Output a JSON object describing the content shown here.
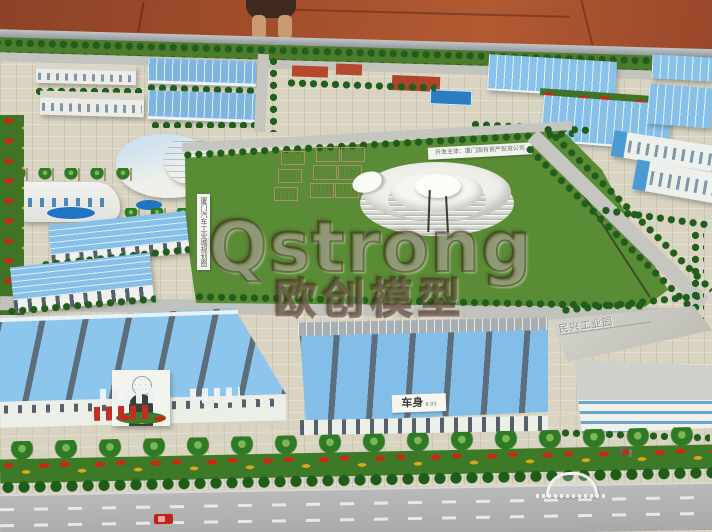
{
  "photo": {
    "subject": "Architectural scale model of an automobile industrial park",
    "watermark": {
      "brand": "Qstrong",
      "brand_cn": "欧创模型"
    },
    "signs": {
      "planning_vertical": "厦门汽车工业城规划图",
      "developer": "开发主体：厦门国有资产投资公司",
      "body_workshop": "车身",
      "body_workshop_area": "6.93",
      "park_roof": "民兴工业园"
    },
    "colors": {
      "floor": "#a04e2c",
      "grass": "#5a8c36",
      "factory_roof_blue": "#86c2ea",
      "pool_blue": "#2277c8",
      "road_gray": "#b2b4b4",
      "pavement": "#d6d0bf",
      "flower_red": "#cc2810",
      "flower_yellow": "#e2a418",
      "wood_block": "#d8c49a"
    }
  }
}
